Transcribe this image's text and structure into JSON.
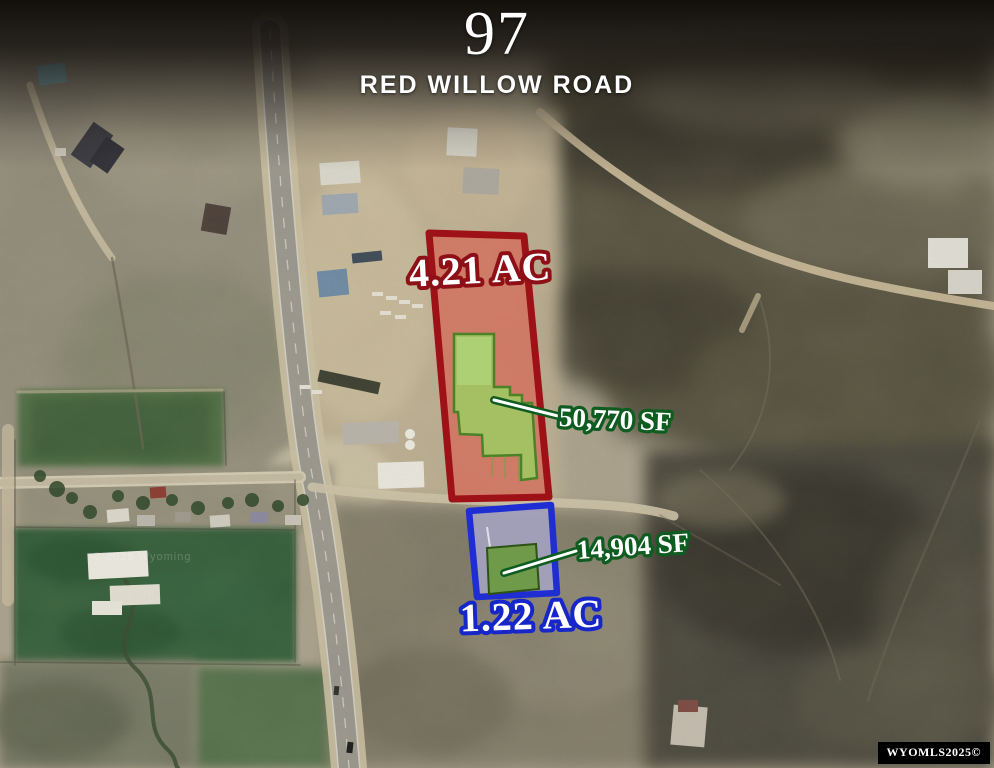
{
  "header": {
    "street_number": "97",
    "street_name": "RED WILLOW ROAD"
  },
  "parcels": {
    "red": {
      "acreage": "4.21 AC",
      "building_sf": "50,770 SF"
    },
    "blue": {
      "acreage": "1.22 AC",
      "building_sf": "14,904 SF"
    }
  },
  "watermarks": {
    "mls": "WYOMLS2025©",
    "imagery": "© 2025 Wyoming"
  },
  "colors": {
    "red_outline": "#9e1117",
    "red_fill": "#e03a33",
    "red_text_stroke": "#8e1016",
    "blue_outline": "#1e2ed2",
    "blue_fill": "#8b8ad6",
    "blue_text_stroke": "#1626c8",
    "green_building_fill": "#9ccf63",
    "green_building_outline": "#4b8226",
    "green_building_dark_fill": "#679a3a",
    "green_text_stroke": "#0f5c20",
    "label_fill": "#ffffff"
  }
}
